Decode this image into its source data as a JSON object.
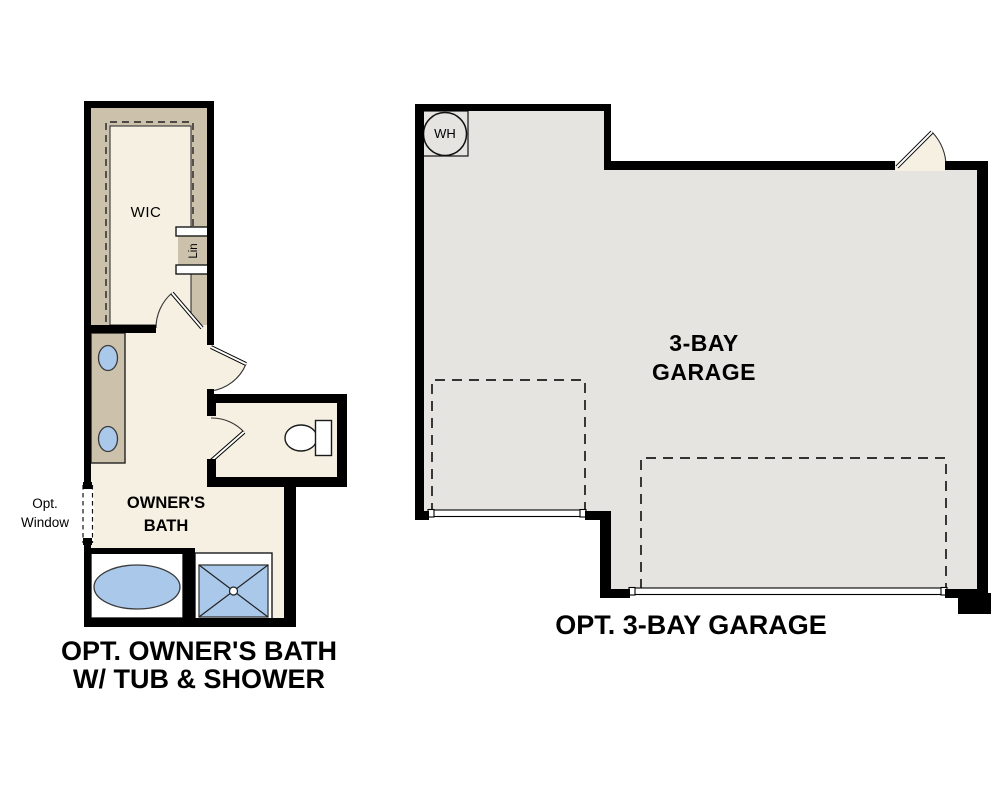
{
  "colors": {
    "wall": "#000000",
    "floor_cream": "#f6f0e2",
    "floor_tan": "#ccc2ac",
    "floor_gray": "#e5e4e1",
    "fixture_blue": "#a9c8ea",
    "background": "#ffffff"
  },
  "plans": {
    "owners_bath": {
      "caption_line1": "OPT. OWNER'S BATH",
      "caption_line2": "W/ TUB & SHOWER",
      "labels": {
        "wic": "WIC",
        "linen": "Lin",
        "room_line1": "OWNER'S",
        "room_line2": "BATH",
        "window_line1": "Opt.",
        "window_line2": "Window"
      }
    },
    "garage": {
      "caption": "OPT. 3-BAY GARAGE",
      "labels": {
        "room_line1": "3-BAY",
        "room_line2": "GARAGE",
        "water_heater": "WH"
      }
    }
  }
}
